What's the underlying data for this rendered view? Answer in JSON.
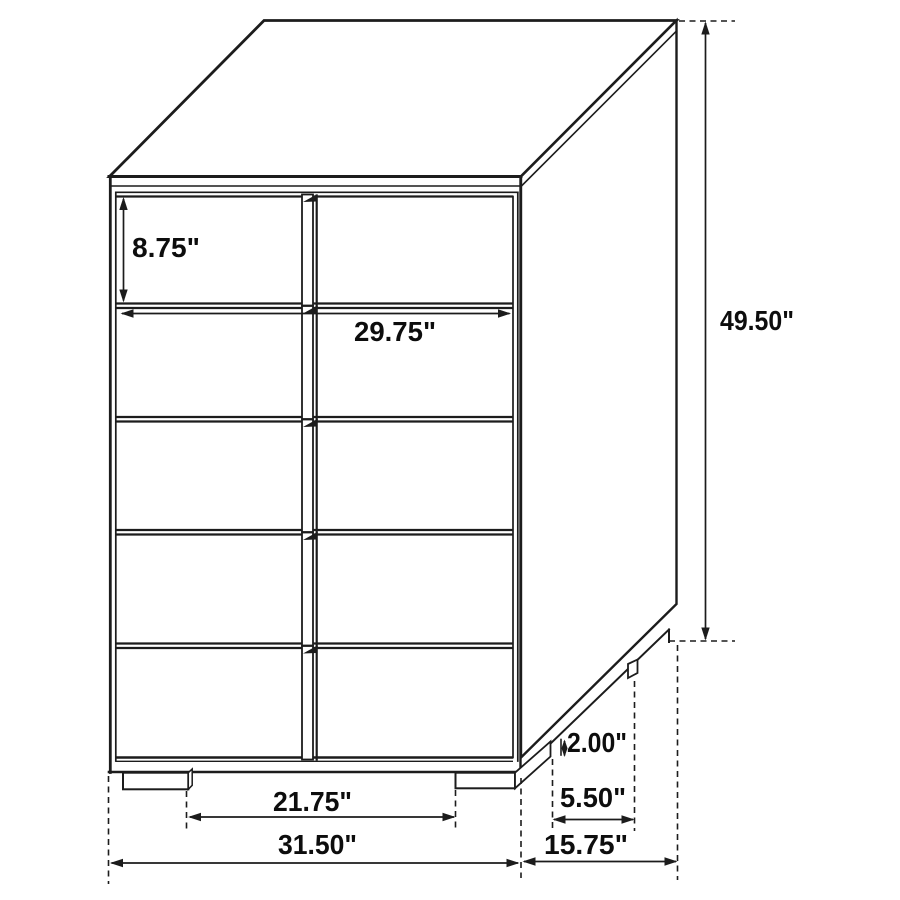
{
  "diagram": {
    "subject": "5-drawer-chest-dimension-drawing",
    "dimensions": {
      "drawer_height": "8.75\"",
      "drawer_width": "29.75\"",
      "overall_height": "49.50\"",
      "foot_height": "2.00\"",
      "side_foot_spacing": "5.50\"",
      "front_foot_spacing": "21.75\"",
      "overall_width": "31.50\"",
      "overall_depth": "15.75\""
    },
    "colors": {
      "line": "#1c1c1c",
      "label": "#0d0d0d",
      "background": "#ffffff"
    }
  }
}
